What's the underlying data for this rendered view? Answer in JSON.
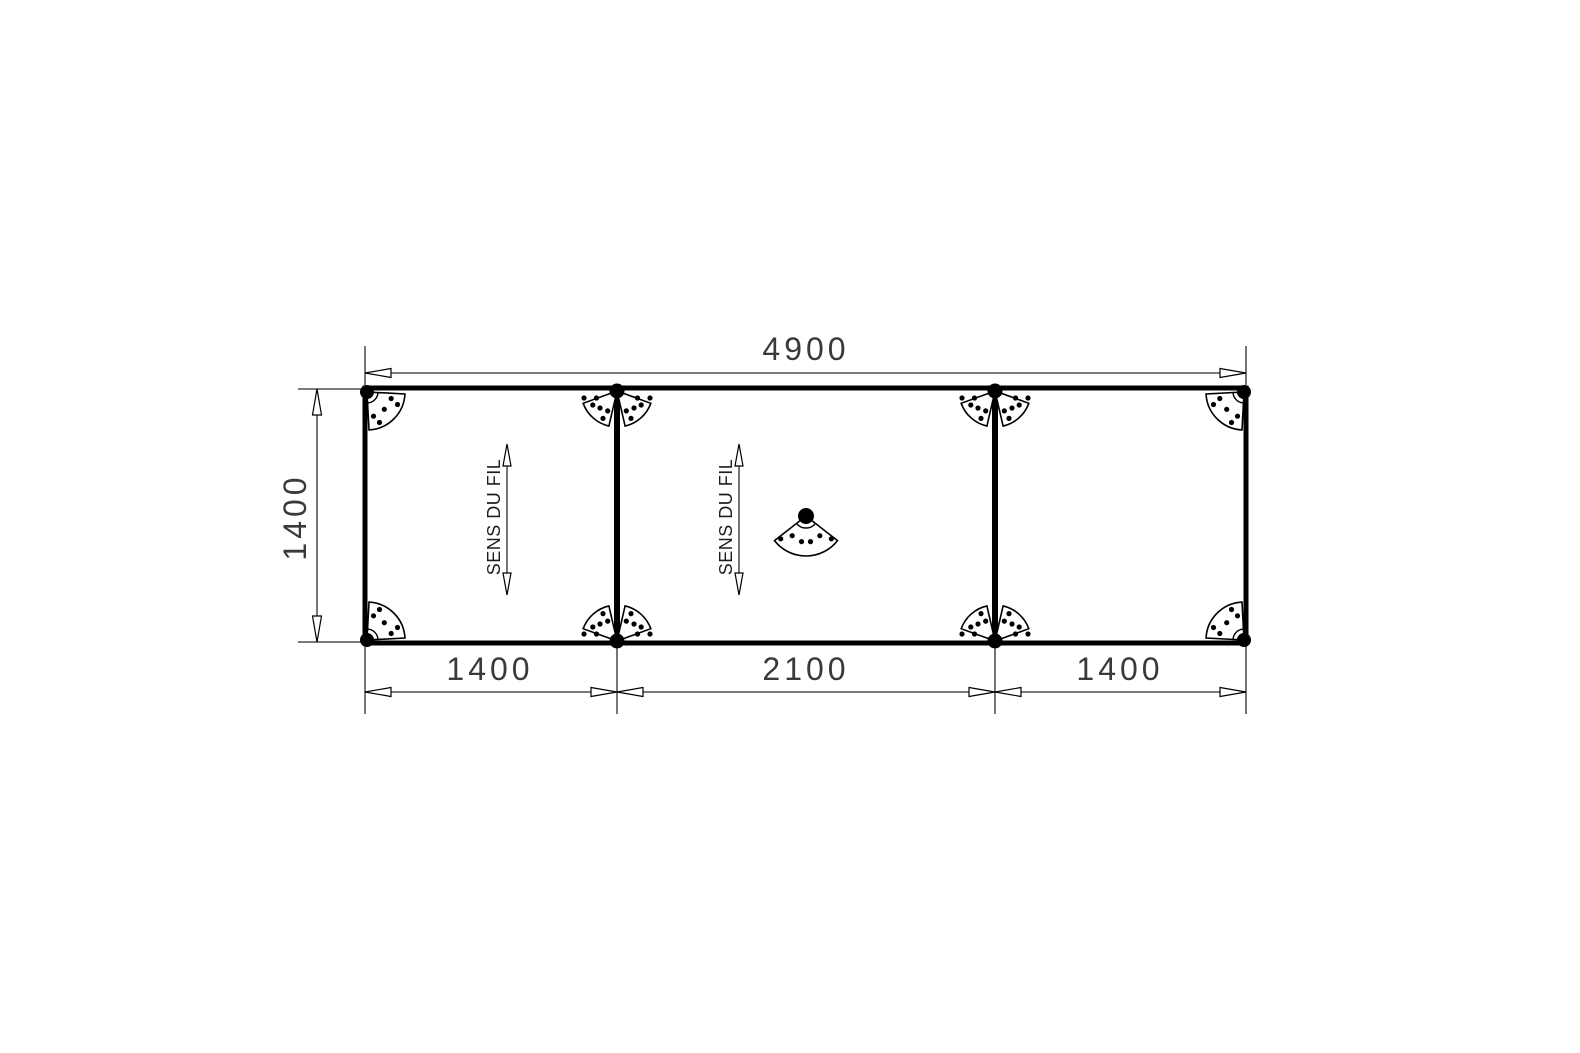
{
  "colors": {
    "line": "#000000",
    "dimension_line": "#2b2b2b",
    "text": "#3a3a3a",
    "background": "#ffffff"
  },
  "dimensions": {
    "overall_width": {
      "label": "4900"
    },
    "overall_height": {
      "label": "1400"
    },
    "sections": [
      {
        "label": "1400"
      },
      {
        "label": "2100"
      },
      {
        "label": "1400"
      }
    ]
  },
  "annotations": {
    "grain": [
      {
        "label": "SENS DU FIL"
      },
      {
        "label": "SENS DU FIL"
      }
    ]
  }
}
